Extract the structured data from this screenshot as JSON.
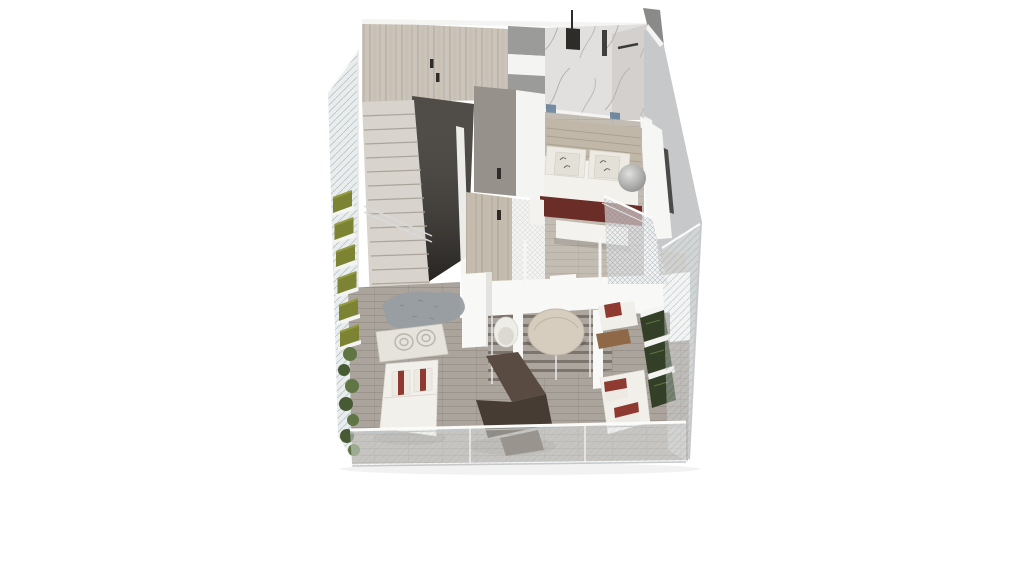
{
  "scene": {
    "description": "Isometric 3D cutaway render of a duplex apartment floor plan on a plain white background",
    "background": "#ffffff"
  },
  "palette": {
    "background": "#ffffff",
    "glass_tint": "#e9edee",
    "wood_wall": "#cbc4ba",
    "wall_white": "#f4f4f2",
    "cabinet_gray": "#9b9b99",
    "marble_floor": "#e2e0de",
    "marble_wall": "#d3d0cd",
    "fixture_dark": "#2e2c29",
    "door_wall_gray": "#96928b",
    "right_wall": "#c6c8ca",
    "window_slit": "#4b4a48",
    "dark_feature_wall": "#37332e",
    "stair_tread": "#d8d4cd",
    "wood_screen": "#c4bcae",
    "bedroom_floor": "#c2bcb3",
    "headboard_wood": "#c1b7a9",
    "bed_white": "#f3f1ec",
    "pillow_white": "#eceae3",
    "burgundy_runner": "#6b2d27",
    "pillow_red": "#8e3a30",
    "bench_white": "#f4f2ee",
    "pendant_gray": "#a7a7a5",
    "parapet_white": "#f6f6f4",
    "slab_white": "#f8f8f7",
    "deck_wood": "#aba49d",
    "terrace_light": "#c5c1bb",
    "dining_floor": "#aca69e",
    "dining_table": "#d7cdbf",
    "tub_chair_white": "#efede8",
    "rug_gray": "#989ea2",
    "rug_pattern": "#e6e3dc",
    "chaise_white": "#f2f0eb",
    "armchair_brown": "#5a4b42",
    "armchair_brown_dark": "#473c34",
    "sofa_white": "#f1efe9",
    "side_table_wood": "#8f6847",
    "hedge_dark": "#333f26",
    "planter_olive": "#7c8433",
    "planter_olive_light": "#939a3f",
    "bush_green": "#5f7544",
    "bush_green_dark": "#475a33",
    "glass_door_blue": "#5f7c96"
  }
}
